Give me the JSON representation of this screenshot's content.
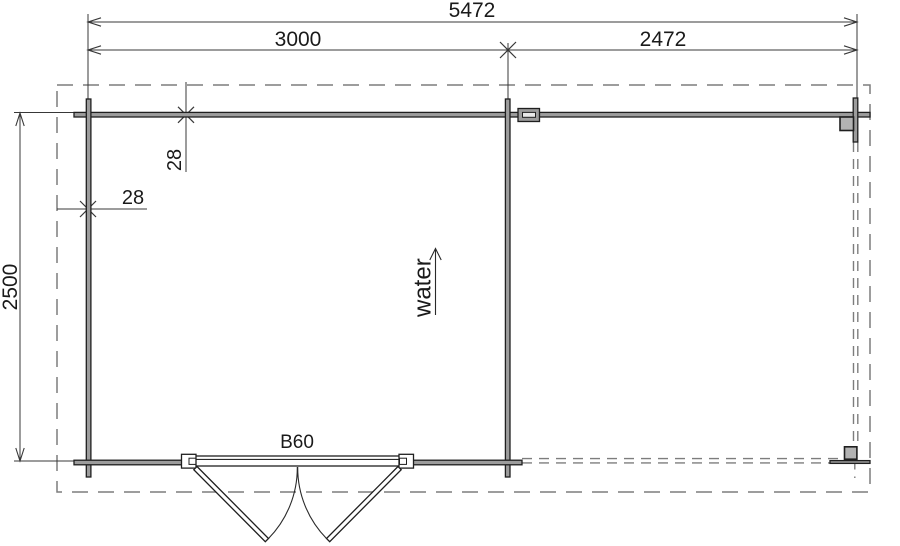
{
  "floor_plan": {
    "description": "Log cabin floor plan with enclosed room and open veranda",
    "dimensions": {
      "total_width": "5472",
      "cabin_width": "3000",
      "veranda_width": "2472",
      "depth": "2500",
      "wall_thickness_top": "28",
      "wall_thickness_side": "28"
    },
    "annotations": {
      "door_label": "B60",
      "water_label": "water"
    },
    "colors": {
      "line": "#1f1f1f",
      "dimension_line": "#383838",
      "wall_fill": "#9c9c9c",
      "post_fill": "#b3b3b3",
      "dashed_outline": "#7d7d7d",
      "background": "#ffffff"
    }
  }
}
